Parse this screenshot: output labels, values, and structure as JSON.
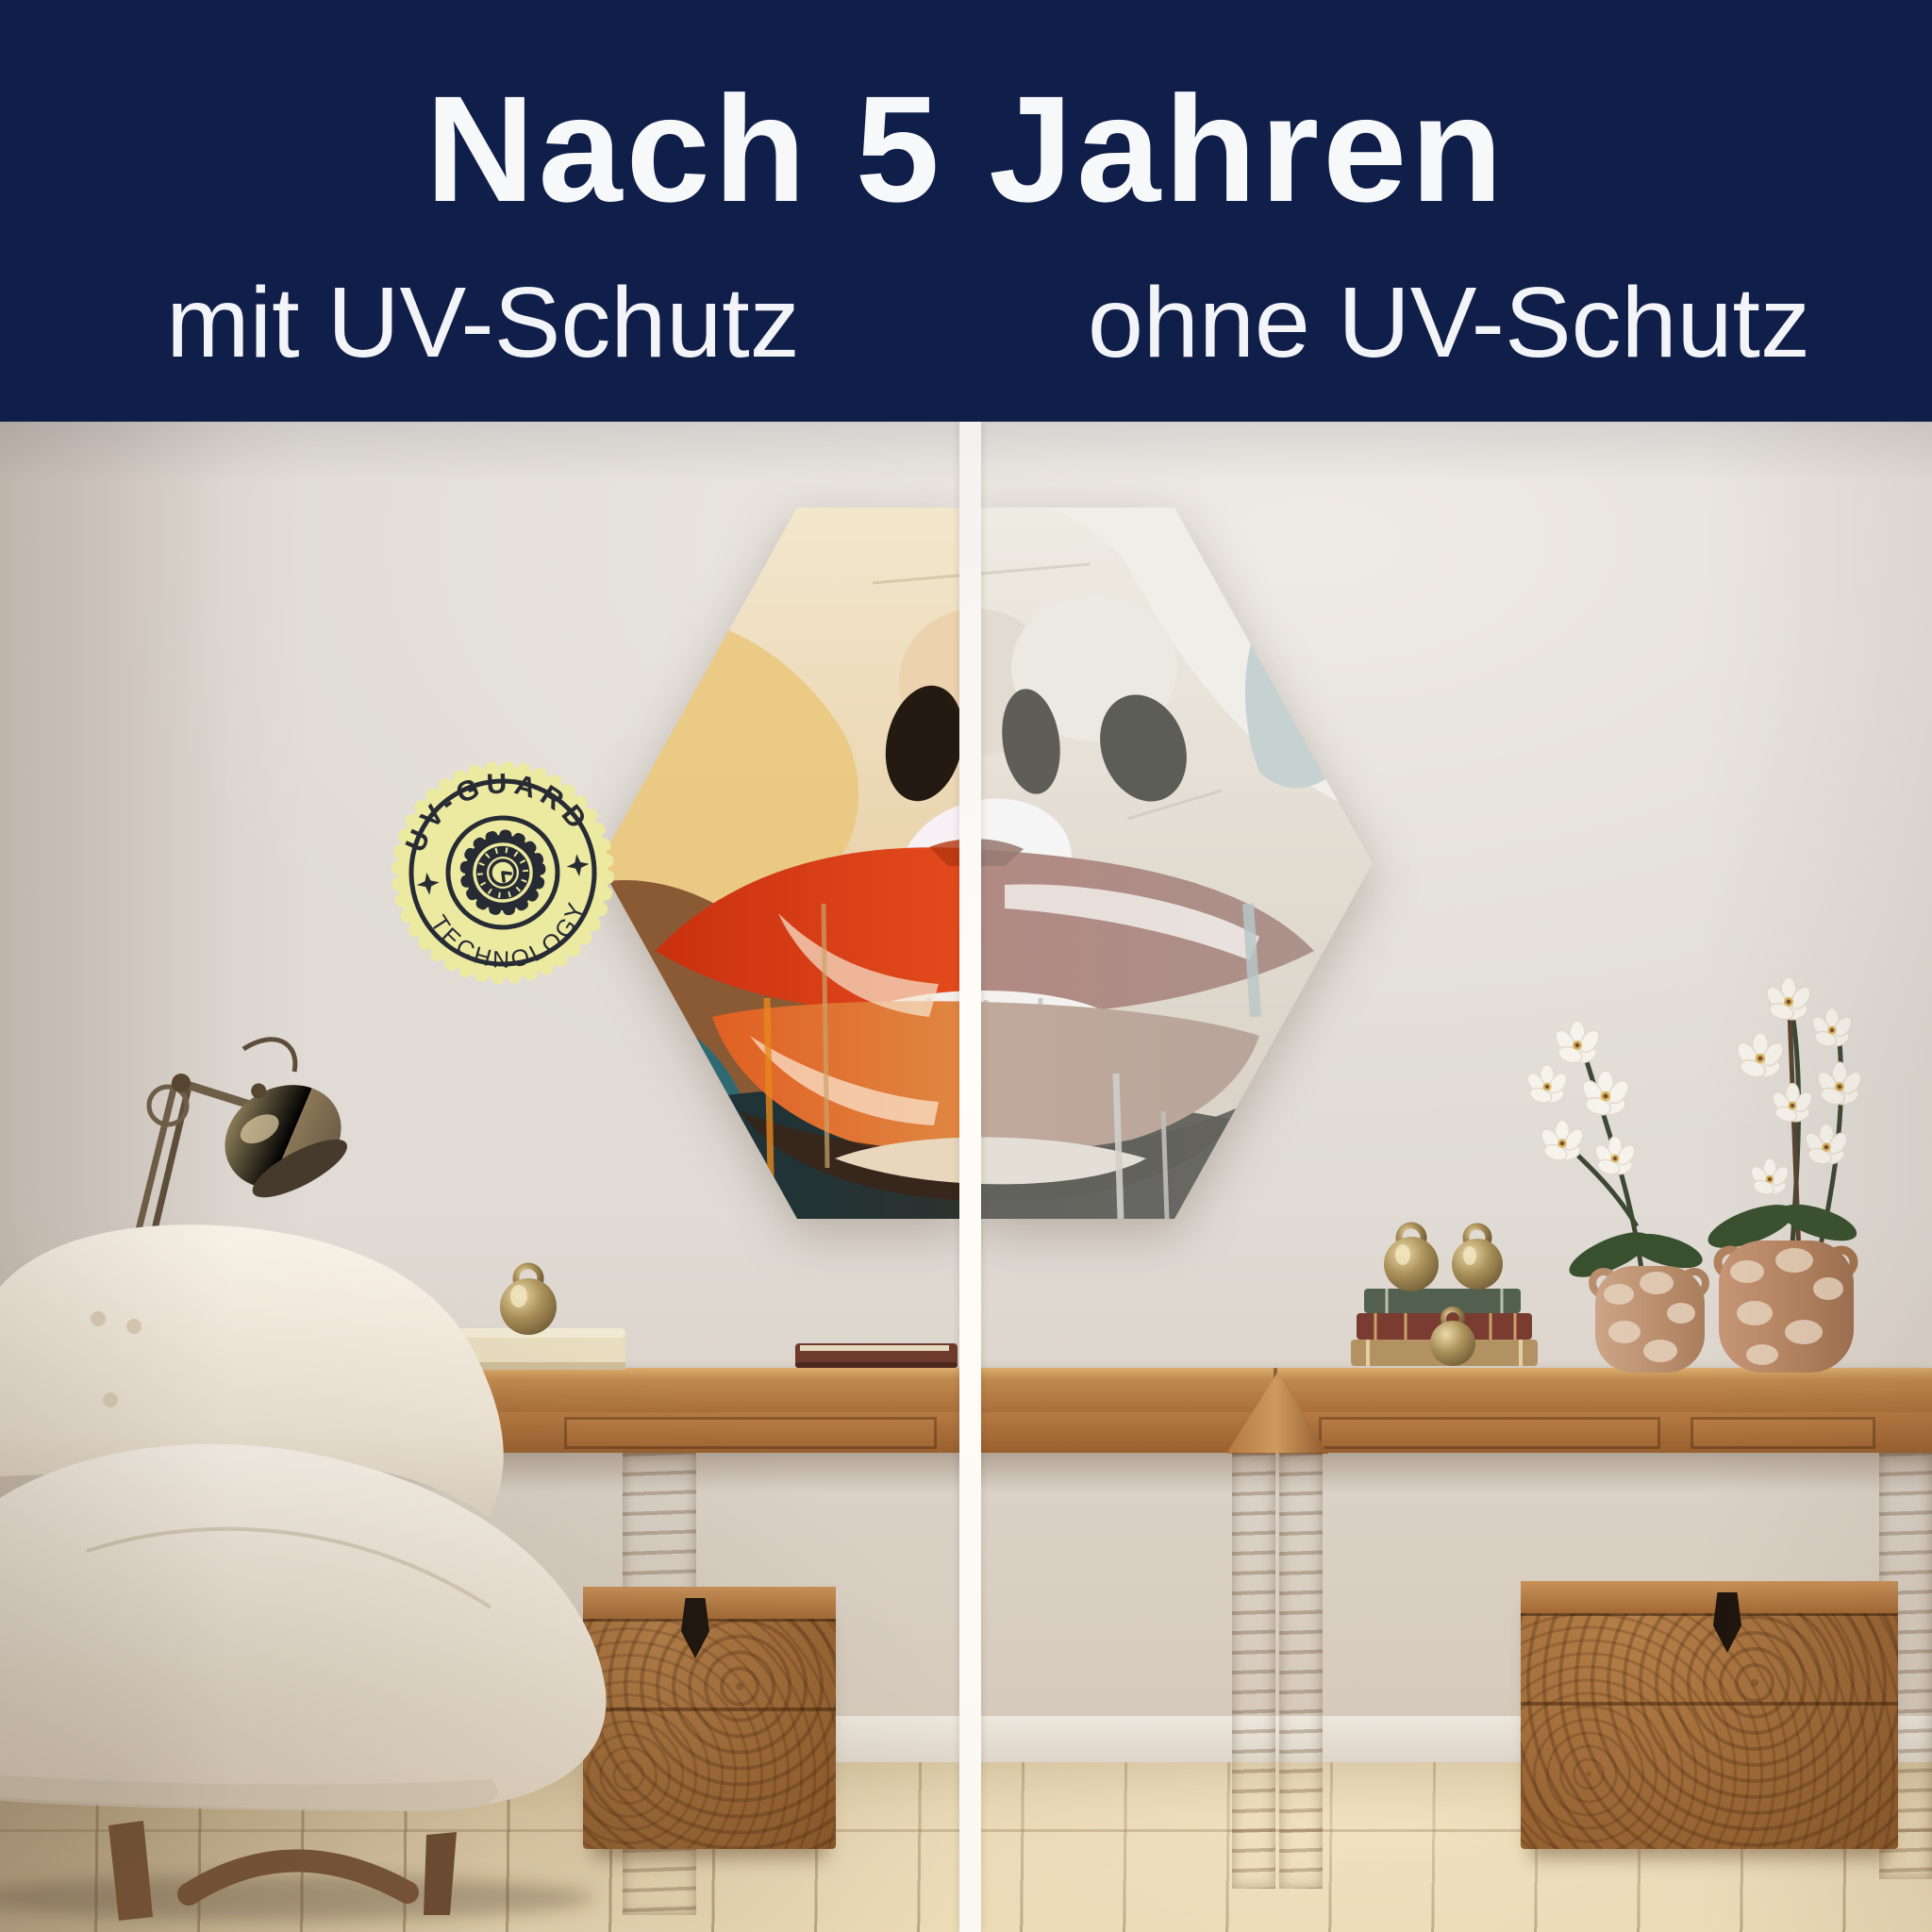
{
  "banner": {
    "title": "Nach 5 Jahren",
    "left_label": "mit UV-Schutz",
    "right_label": "ohne UV-Schutz",
    "background_color": "#101f4a",
    "text_color": "#f7f8fa"
  },
  "badge": {
    "top_text": "UV-GUARD",
    "bottom_text": "TECHNOLOGY",
    "background_color": "#ece9a1",
    "foreground_color": "#272b33",
    "icons": [
      "four-point-star",
      "gear-clock",
      "four-point-star"
    ]
  },
  "comparison": {
    "divider_color": "#fbfaf7",
    "left_side": "vivid artwork (with UV protection)",
    "right_side": "faded artwork (without UV protection)"
  },
  "scene": {
    "wall_color": "#e0dbd5",
    "alcove_wall_color": "#d7c7b2",
    "floor_color": "#e3d4b2",
    "wood_color": "#a96f3e",
    "artwork": {
      "shape": "hexagon",
      "subject": "abstract-lips-painting",
      "accent_red": "#d84a1e",
      "accent_orange": "#e8871f",
      "accent_teal": "#2e6a72",
      "accent_blue": "#9fd0d8",
      "skin_cream": "#ecd9b8"
    }
  }
}
